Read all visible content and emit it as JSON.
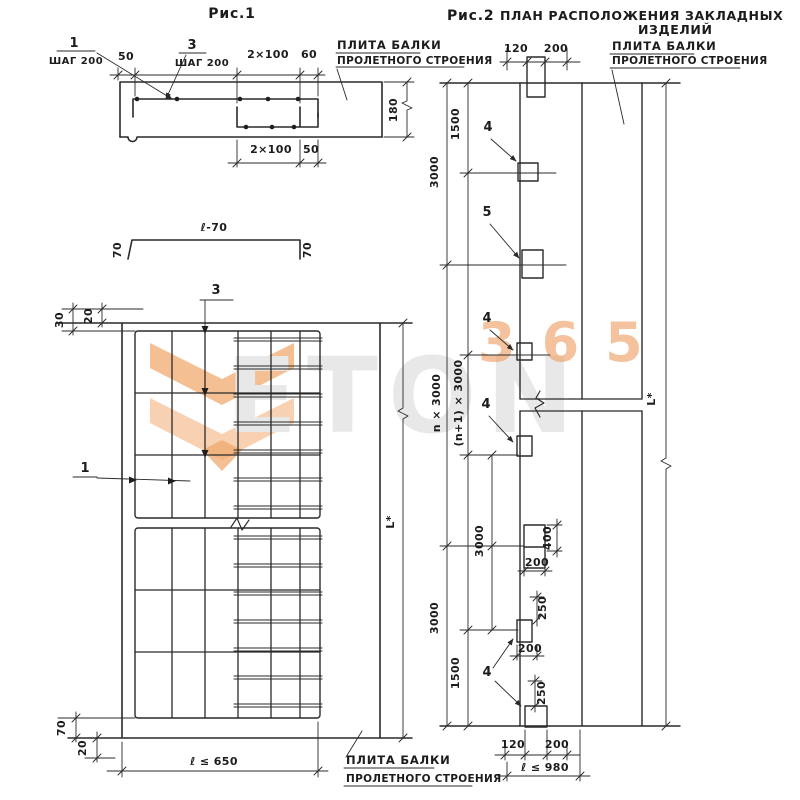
{
  "watermark": {
    "brand": "ETON",
    "number": "365",
    "accent_orange": "#f09d63",
    "light_orange": "#f6c9a4",
    "gray": "#e8e8e8"
  },
  "fig1": {
    "title": "Рис.1",
    "mark1": {
      "number": "1",
      "note": "ШАГ 200"
    },
    "mark3": {
      "number": "3",
      "note": "ШАГ 200"
    },
    "slab_label": {
      "line1": "ПЛИТА БАЛКИ",
      "line2": "ПРОЛЕТНОГО СТРОЕНИЯ"
    },
    "dims": {
      "top_50": "50",
      "top_2x100": "2×100",
      "top_60": "60",
      "height": "180",
      "bottom_2x100": "2×100",
      "bottom_50": "50"
    }
  },
  "channel": {
    "label": "ℓ-70",
    "left_leg": "70",
    "right_leg": "70"
  },
  "plan": {
    "mark3": "3",
    "mark1": "1",
    "slab_label": {
      "line1": "ПЛИТА БАЛКИ",
      "line2": "ПРОЛЕТНОГО СТРОЕНИЯ"
    },
    "dims": {
      "top_20": "20",
      "top_30": "30",
      "bottom_70": "70",
      "bottom_20": "20",
      "width_limit": "ℓ ≤ 650",
      "length": "L*"
    }
  },
  "fig2": {
    "title": {
      "fig": "Рис.2",
      "line1": "ПЛАН РАСПОЛОЖЕНИЯ ЗАКЛАДНЫХ",
      "line2": "ИЗДЕЛИЙ"
    },
    "slab_label": {
      "line1": "ПЛИТА БАЛКИ",
      "line2": "ПРОЛЕТНОГО СТРОЕНИЯ"
    },
    "marks": {
      "top": "4",
      "second": "5",
      "third": "4",
      "fourth": "4",
      "bottom": "4"
    },
    "dims": {
      "top_120": "120",
      "top_200": "200",
      "seg_3000_top": "3000",
      "seg_1500_top": "1500",
      "n_3000": "n × 3000",
      "n1_3000": "(n+1) × 3000",
      "seg_3000_mid": "3000",
      "seg_3000_low": "3000",
      "seg_1500_bot": "1500",
      "plate_400": "400",
      "plate_200_a": "200",
      "gap_250_a": "250",
      "plate_200_b": "200",
      "gap_250_b": "250",
      "bot_120": "120",
      "bot_200": "200",
      "length_limit": "ℓ ≤ 980",
      "overall": "L*"
    }
  }
}
